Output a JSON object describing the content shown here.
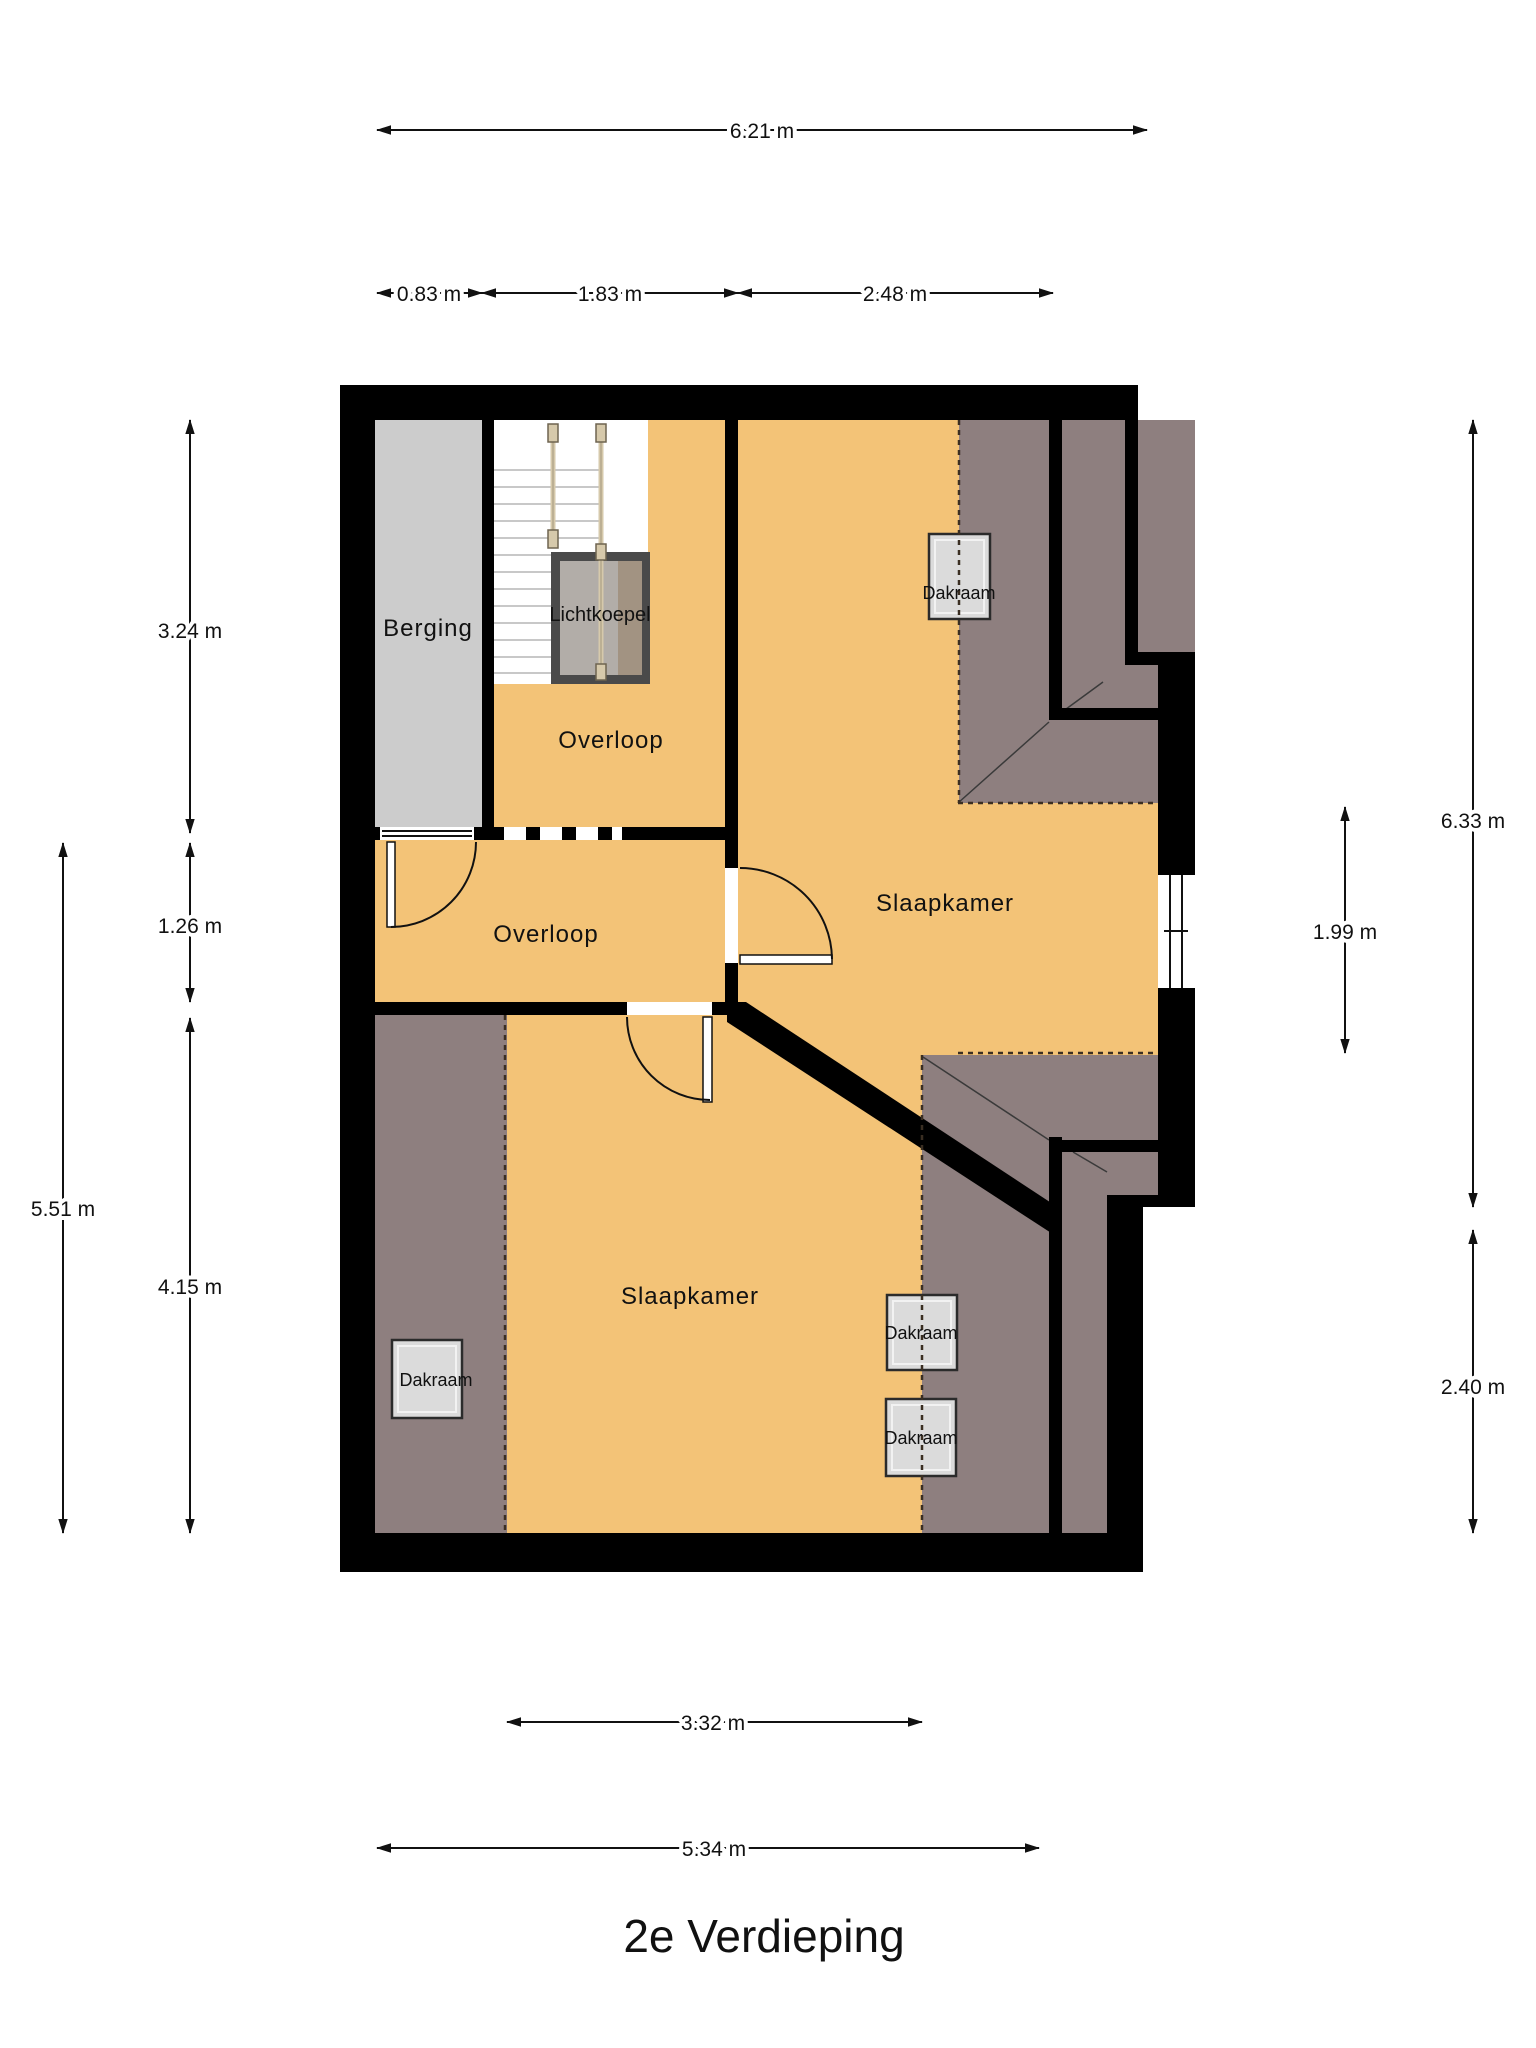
{
  "title": "2e Verdieping",
  "rooms": {
    "berging": "Berging",
    "overloop_top": "Overloop",
    "overloop_bottom": "Overloop",
    "slaapkamer_right": "Slaapkamer",
    "slaapkamer_bottom": "Slaapkamer"
  },
  "features": {
    "lichtkoepel": "Lichtkoepel",
    "dakraam_top_right": "Dakraam",
    "dakraam_bottom_left": "Dakraam",
    "dakraam_right_1": "Dakraam",
    "dakraam_right_2": "Dakraam"
  },
  "dimensions": {
    "top_total": "6.21 m",
    "top_berging": "0.83 m",
    "top_stairs": "1.83 m",
    "top_bedroom": "2.48 m",
    "left_upper": "3.24 m",
    "left_middle": "1.26 m",
    "left_total": "5.51 m",
    "left_lower": "4.15 m",
    "right_total": "6.33 m",
    "right_window": "1.99 m",
    "right_lower": "2.40 m",
    "bottom_inner": "3.32 m",
    "bottom_total": "5.34 m"
  },
  "colors": {
    "floor": "#f3c377",
    "sloped_ceiling": "#8e7f7f",
    "storage": "#cccccc",
    "wall": "#000000"
  }
}
